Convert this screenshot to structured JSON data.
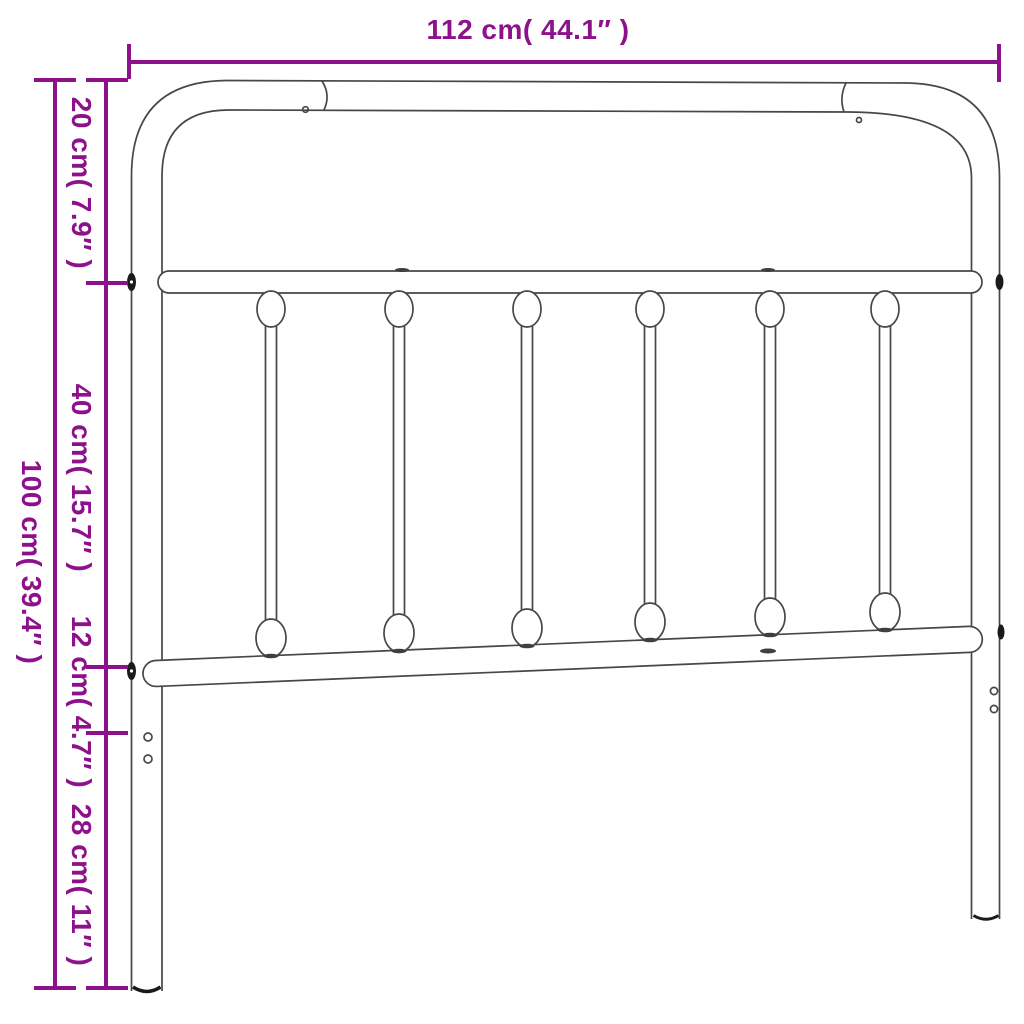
{
  "figure": {
    "description": "Line drawing of a metal bed headboard with curved top frame, top and bottom horizontal rails, six vertical spindles with decorative oval knuckles, and two legs",
    "spindle_count": 6,
    "leg_count": 2
  },
  "colors": {
    "accent_purple": "#8E118C",
    "drawing_line": "#474747",
    "background": "#ffffff"
  },
  "dimensions": {
    "width": {
      "label": "112 cm( 44.1″ )",
      "cm": 112,
      "inches": 44.1,
      "orientation": "horizontal"
    },
    "total_height": {
      "label": "100 cm( 39.4″ )",
      "cm": 100,
      "inches": 39.4,
      "orientation": "vertical"
    },
    "top_section": {
      "label": "20 cm( 7.9″ )",
      "cm": 20,
      "inches": 7.9,
      "orientation": "vertical"
    },
    "spindle_section": {
      "label": "40 cm( 15.7″ )",
      "cm": 40,
      "inches": 15.7,
      "orientation": "vertical"
    },
    "rail_section": {
      "label": "12 cm( 4.7″ )",
      "cm": 12,
      "inches": 4.7,
      "orientation": "vertical"
    },
    "leg_section": {
      "label": "28 cm( 11″ )",
      "cm": 28,
      "inches": 11,
      "orientation": "vertical"
    }
  }
}
